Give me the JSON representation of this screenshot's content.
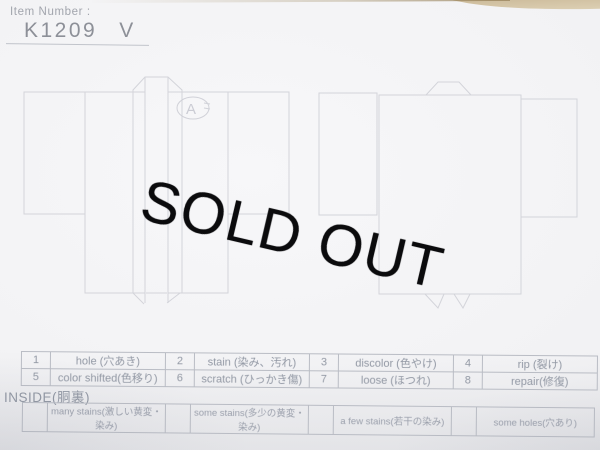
{
  "header": {
    "item_number_label": "Item Number :",
    "item_number_value": "K1209",
    "item_number_variant": "V"
  },
  "overlay": {
    "sold_out": "SOLD OUT"
  },
  "diagram": {
    "annotation": "A"
  },
  "flaw_table": {
    "cells": [
      {
        "num": "1",
        "label": "hole (穴あき)"
      },
      {
        "num": "2",
        "label": "stain (染み、汚れ)"
      },
      {
        "num": "3",
        "label": "discolor (色やけ)"
      },
      {
        "num": "4",
        "label": "rip (裂け)"
      },
      {
        "num": "5",
        "label": "color shifted(色移り)"
      },
      {
        "num": "6",
        "label": "scratch (ひっかき傷)"
      },
      {
        "num": "7",
        "label": "loose (ほつれ)"
      },
      {
        "num": "8",
        "label": "repair(修復)"
      }
    ]
  },
  "inside": {
    "label": "INSIDE(胴裏)",
    "options": [
      "many stains(激しい黄変・染み)",
      "some stains(多少の黄変・染み)",
      "a few stains(若干の染み)",
      "some holes(穴あり)"
    ]
  },
  "colors": {
    "paper": "#f2f2f4",
    "table_line": "#b9bcc4",
    "diagram_line": "#d3d4da",
    "text_gray": "#9298a4",
    "sold_out": "#0b0b0d",
    "surface_tan": "#cdbc9c"
  }
}
